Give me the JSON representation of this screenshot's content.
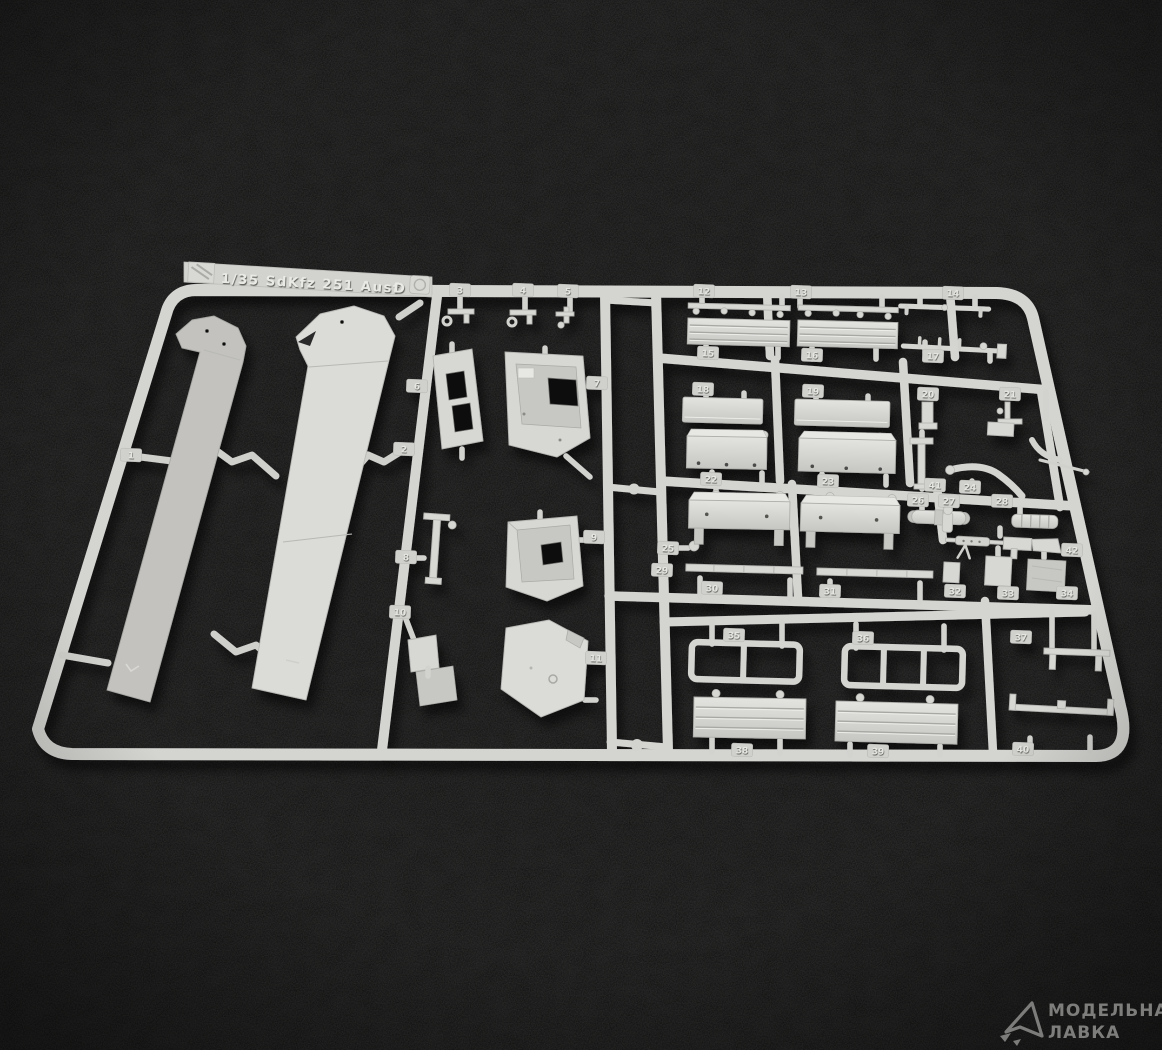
{
  "sprue": {
    "plastic_color": "#d6d6d3",
    "tag": {
      "label": "1/35  SdKfz 251 Ausf",
      "variant": "D"
    }
  },
  "parts": [
    "1",
    "2",
    "3",
    "4",
    "5",
    "6",
    "7",
    "8",
    "9",
    "10",
    "11",
    "12",
    "13",
    "14",
    "15",
    "16",
    "17",
    "18",
    "19",
    "20",
    "21",
    "22",
    "23",
    "24",
    "25",
    "26",
    "27",
    "28",
    "29",
    "30",
    "31",
    "32",
    "33",
    "34",
    "35",
    "36",
    "37",
    "38",
    "39",
    "40",
    "41",
    "42"
  ],
  "background": {
    "color": "#0c0c0c"
  },
  "watermark": {
    "line1": "МОДЕЛЬНАЯ",
    "line2": "ЛАВКА",
    "color": "#90908e"
  }
}
